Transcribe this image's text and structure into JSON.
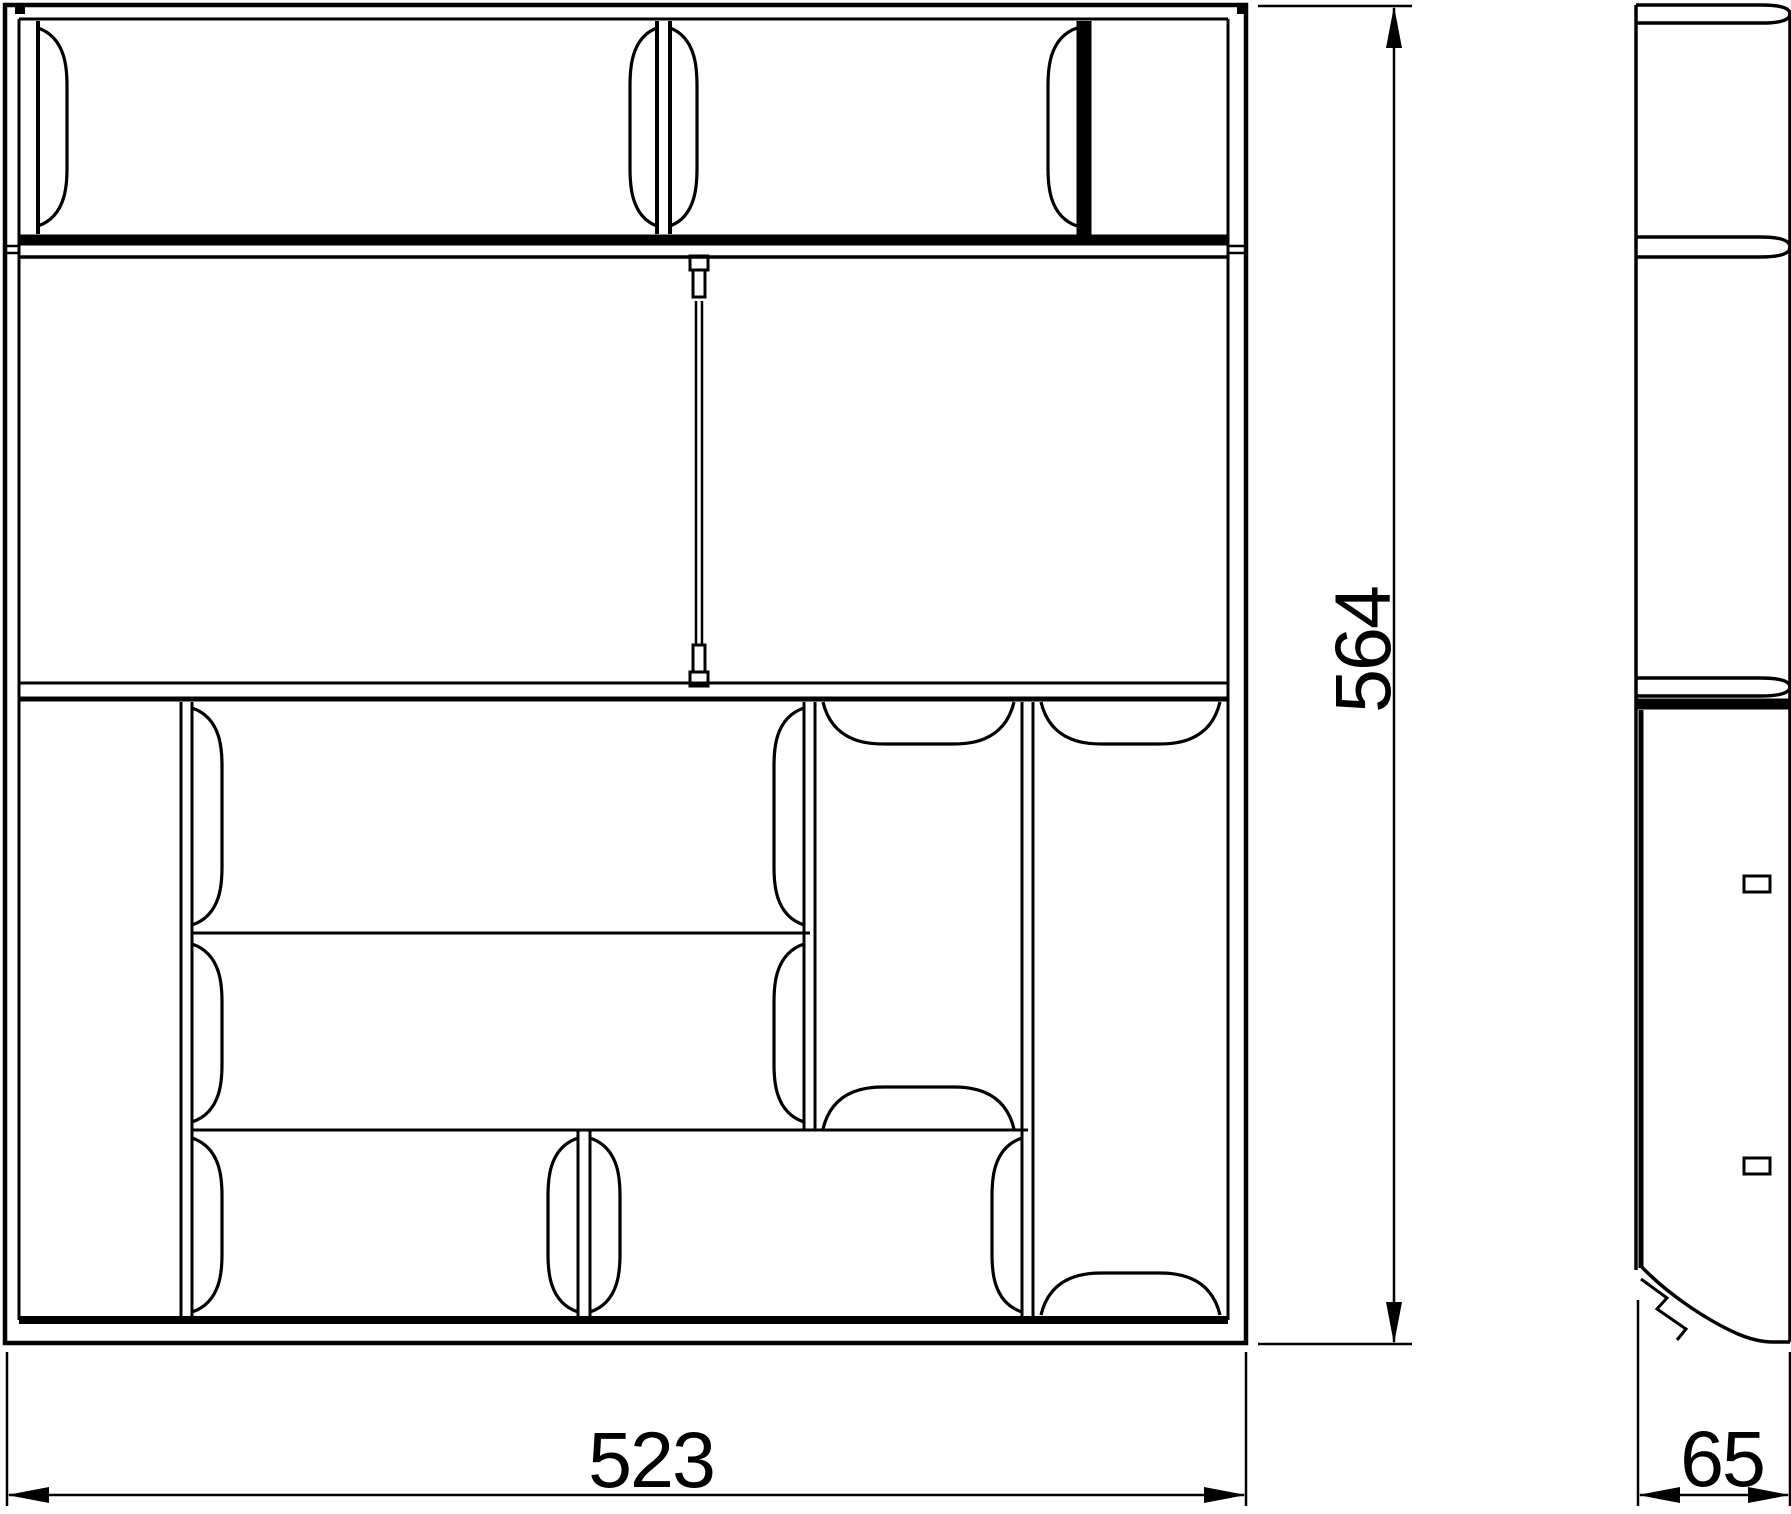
{
  "canvas": {
    "width": 1791,
    "height": 1514,
    "background": "#ffffff",
    "line_color": "#000000"
  },
  "drawing": {
    "type": "orthographic technical drawing",
    "front_view": "front elevation with compartments and spring divider clips",
    "side_view": "side profile with shelf rails, slots and chamfered foot"
  },
  "dimensions": {
    "height": {
      "label": "564",
      "orientation": "vertical"
    },
    "width": {
      "label": "523",
      "orientation": "horizontal"
    },
    "depth": {
      "label": "65",
      "orientation": "horizontal"
    }
  }
}
